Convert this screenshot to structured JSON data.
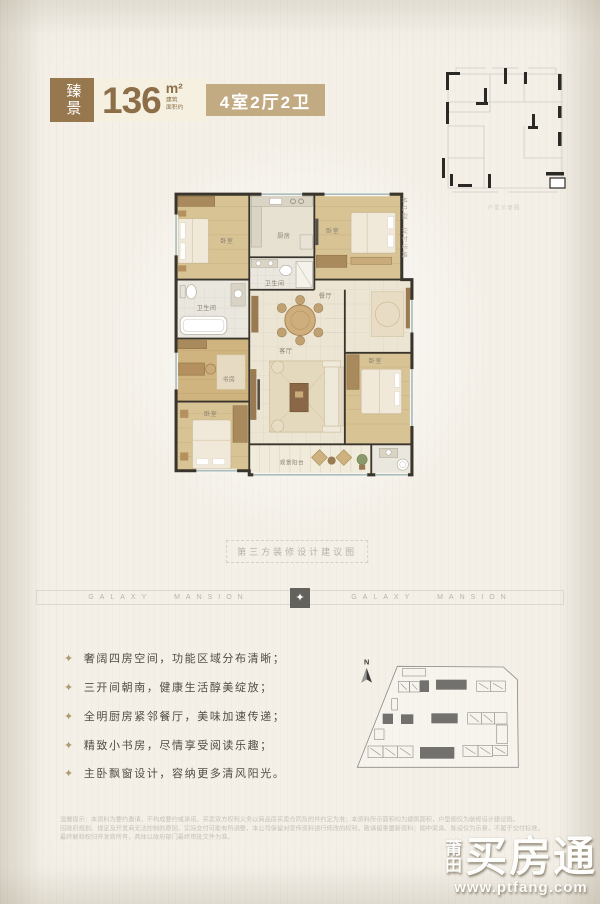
{
  "colors": {
    "badge_brown": "#96774e",
    "layout_tan": "#c2aa83",
    "number_brown": "#8c6f48",
    "bullet_gold": "#b29a6f"
  },
  "badge": {
    "project_tag": "臻景",
    "area_value": "136",
    "area_unit": "m²",
    "area_note_line1": "建筑",
    "area_note_line2": "面积约",
    "layout": "4室2厅2卫"
  },
  "mini_plan": {
    "caption": "户型示意图"
  },
  "floor_plan": {
    "side_note_line1": "本户型",
    "side_note_line2": "交付标准",
    "rooms": {
      "bedroom_tl": "卧室",
      "bath_left": "卫生间",
      "study": "书房",
      "bedroom_bl": "卧室",
      "kitchen": "厨房",
      "bath_center": "卫生间",
      "bedroom_tr": "卧室",
      "dining": "餐厅",
      "living": "客厅",
      "bedroom_right": "卧室",
      "balcony": "观景阳台"
    }
  },
  "divider": {
    "caption": "第三方装修设计建议图"
  },
  "band": {
    "left_text": "GALAXY MANSION",
    "right_text": "GALAXY MANSION",
    "diamond": "✦"
  },
  "features": {
    "bullet": "✦",
    "items": [
      "奢阔四房空间，功能区域分布清晰；",
      "三开间朝南，健康生活醇美绽放；",
      "全明厨房紧邻餐厅，美味加速传递；",
      "精致小书房，尽情享受阅读乐趣；",
      "主卧飘窗设计，容纳更多清风阳光。"
    ]
  },
  "site_plan": {
    "north_label": "N"
  },
  "disclaimer": {
    "lines": [
      "温馨提示：本资料为要约邀请，不构成要约或承诺，买卖双方权利义务以商品房买卖合同及附件约定为准；本资料所示面积均为建筑面积，户型图仅为装修设计建议图。",
      "因政府规划、规定及开发商无法控制的原因，实际交付可能有所调整，本公司保留对宣传资料进行修改的权利，敬请留意最新资料；图中家具、陈设仅为示意，不属于交付标准。",
      "最终解释权归开发商所有，具体以政府部门最终审批文件为准。"
    ]
  },
  "watermark": {
    "city_char1": "莆",
    "city_char2": "田",
    "name": "买房通",
    "url": "www.ptfang.com"
  }
}
